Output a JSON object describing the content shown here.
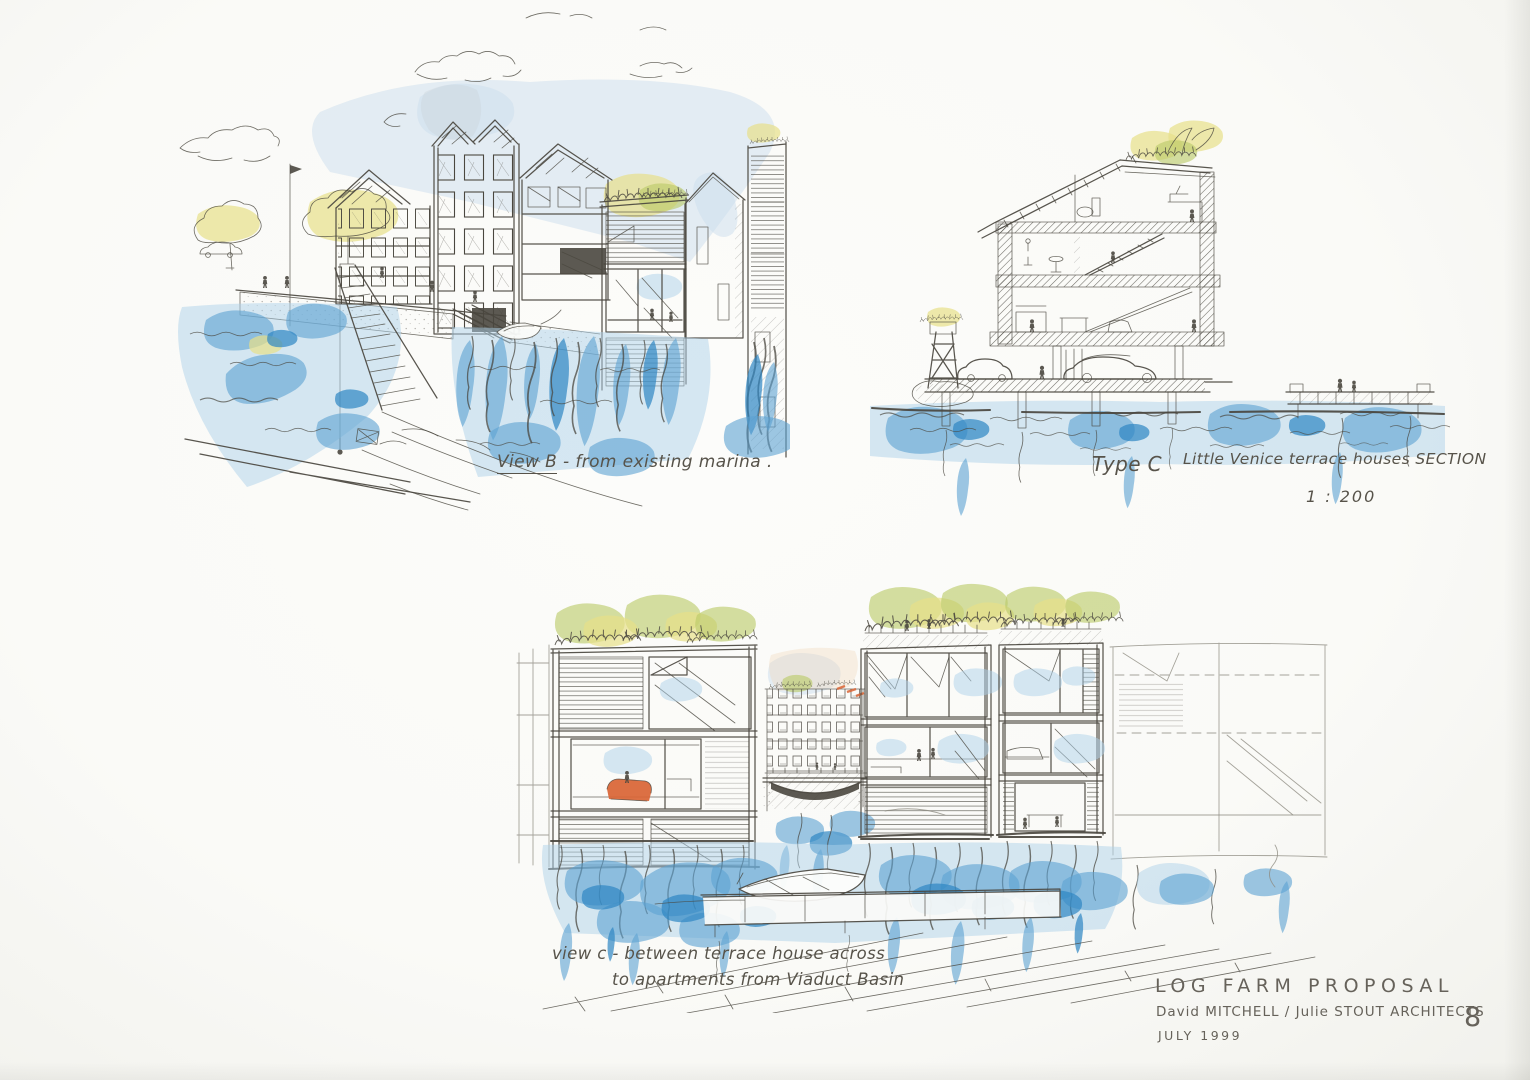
{
  "colors": {
    "paper": "#fafaf7",
    "ink": "#4a473f",
    "ink_light": "#8f8c82",
    "wc_blue": "#5ba2d2",
    "wc_blue_deep": "#2e86c3",
    "wc_blue_pale": "#aed2ea",
    "wc_sky": "#ccdded",
    "wc_yellow": "#e7e089",
    "wc_green": "#b9c968",
    "wc_orange": "#d96434",
    "text": "#57534a"
  },
  "captions": {
    "view_b": {
      "label": "View B",
      "text": "- from existing marina ."
    },
    "type_c": {
      "label": "Type C",
      "title": "Little Venice terrace houses SECTION",
      "scale": "1 : 200"
    },
    "view_c": {
      "line1": "view c  -  between terrace house across",
      "line2": "to apartments  from Viaduct Basin"
    }
  },
  "title_block": {
    "project": "LOG FARM PROPOSAL",
    "architects": "David MITCHELL / Julie STOUT ARCHITECTS",
    "date": "JULY 1999",
    "sheet_number": "8"
  }
}
